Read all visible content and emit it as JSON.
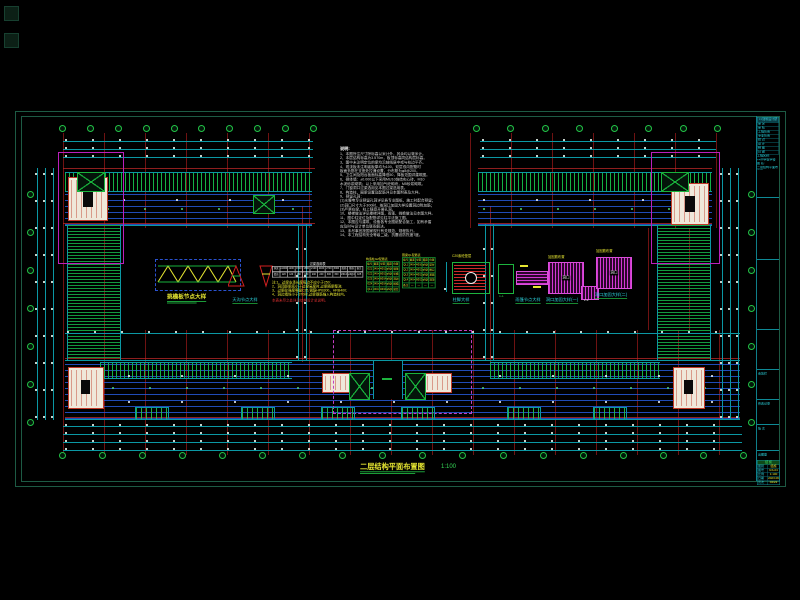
{
  "notes": {
    "title": "说明:",
    "lines": [
      "1、本图所注尺寸除标高以米计外，其余均以毫米计。",
      "2、本层结构标高为3.570m，板顶标高同结构层标高。",
      "3、图中未注明定位的梁均沿轴线居中或与柱边平齐。",
      "4、现浇板未注明者板厚均为100，双层双向配筋时",
      "   板面负筋在支座处拉通设置，分布筋为φ8@200。",
      "5、卫生间及阳台板面标高降低50，降板范围详建筑图。",
      "6、砌体墙：±0.000以下采用MU10烧结实心砖，M10",
      "   水泥砂浆砌筑；以上采用加气砼砌块，M5砂浆砌筑。",
      "7、门窗洞口过梁选用见本图过梁选用表。",
      "8、构造柱、圈梁设置及配筋详见本图附表及大样。",
      "9、预留孔洞：",
      "  (1)水暖电专业预留孔洞详见各专业图纸，施工时配合预留；",
      "  (2)洞口尺寸大于300时，按洞口加固大样设置洞边附加筋；",
      "  (3)严禁在梁、柱上随意开凿孔洞。",
      "10、楼梯做法详见楼梯详图，雨篷、挑檐做法见本图大样。",
      "11、图中柱定位及配筋详见柱平法施工图。",
      "12、本图应与建筑、设备各专业图纸配合施工，如有矛盾",
      "    应及时与设计单位联系解决。",
      "13、未尽事宜按国家现行有关规范、规程执行。",
      "14、本工程结构安全等级二级，抗震设防烈度7度。"
    ]
  },
  "schedule": {
    "title": "过梁选用表",
    "header": [
      "洞宽",
      "≤1000",
      "1200",
      "1500",
      "1800",
      "2100",
      "2400",
      "2700",
      "3000",
      "配筋",
      "箍筋",
      "备注"
    ],
    "row": [
      "梁高",
      "120",
      "120",
      "180",
      "180",
      "240",
      "240",
      "300",
      "300",
      "2Φ14",
      "φ6@200",
      "C25"
    ],
    "notes": [
      "注:1、过梁支承长度每边不应小于250;",
      "2、洞顶距梁底小于过梁高度时,过梁随梁整浇;",
      "3、过梁砼强度等级C25,钢筋HPB300、HRB400;",
      "4、洞边墙垛小于370时,过梁钢筋锚入构造柱内。"
    ],
    "warning": "本表未尽之处详见结构设计总说明。"
  },
  "gz_table": {
    "title": "构造柱GZ配筋表",
    "cells": [
      "编号",
      "截面",
      "纵筋",
      "箍筋",
      "位置",
      "GZ1",
      "240×240",
      "4Φ12",
      "φ6@200",
      "墙角",
      "GZ2",
      "240×370",
      "6Φ12",
      "φ6@200",
      "纵横墙",
      "GZ3",
      "240×490",
      "6Φ14",
      "φ6@200",
      "洞边",
      "GZ4",
      "240×240",
      "4Φ14",
      "φ6@200",
      "楼梯间",
      "QL1",
      "240×180",
      "4Φ10",
      "φ6@200",
      "窗台"
    ]
  },
  "ql_table": {
    "title": "圈梁QL配筋表",
    "cells": [
      "编号",
      "截面",
      "纵筋",
      "箍筋",
      "位置",
      "QL1",
      "240×180",
      "4Φ10",
      "φ6@200",
      "窗台",
      "QL2",
      "240×240",
      "4Φ12",
      "φ6@200",
      "檐口",
      "QL3",
      "240×180",
      "4Φ12",
      "φ6@200",
      "基础",
      "QL4",
      "240×240",
      "6Φ12",
      "φ6@200",
      "洞顶",
      "备注",
      "—",
      "—",
      "—",
      "—"
    ]
  },
  "details": {
    "a_label": "挑檐板节点大样",
    "b_label": "天沟节点大样",
    "f_label": "柱脚大样",
    "f_top": "C20素砼垫层",
    "g_label": "1-1",
    "h_label": "雨篷节点大样",
    "h_note": "Φ8@200",
    "i_title": "加固筋布置",
    "i_core": "洞口",
    "i_label": "洞口加固大样(一)",
    "j_title": "加固筋布置",
    "j_core": "洞口",
    "j_label": "洞口加固大样(二)",
    "k_label": "2-2"
  },
  "drawing_title": {
    "text": "二层结构平面布置图",
    "scale": "1:100"
  },
  "titleblock": {
    "header": "××建筑设计研究院",
    "rows": [
      "审 定",
      "审 核",
      "工程负责",
      "专业负责",
      "校 对",
      "设 计",
      "制 图",
      "日 期"
    ],
    "info_lines": [
      "工程名称:",
      "××中学教学楼",
      "图 名:",
      "二层结构平面布置图"
    ],
    "box_labels": [
      "会签栏",
      "修改记录",
      "版 次",
      "出图章"
    ],
    "table_title": "结 施",
    "table_rows": [
      [
        "图别",
        "结施"
      ],
      [
        "图号",
        "GS-04"
      ],
      [
        "比例",
        "1:100"
      ],
      [
        "日期",
        "2023.06"
      ],
      [
        "页次",
        "04/22"
      ]
    ]
  }
}
